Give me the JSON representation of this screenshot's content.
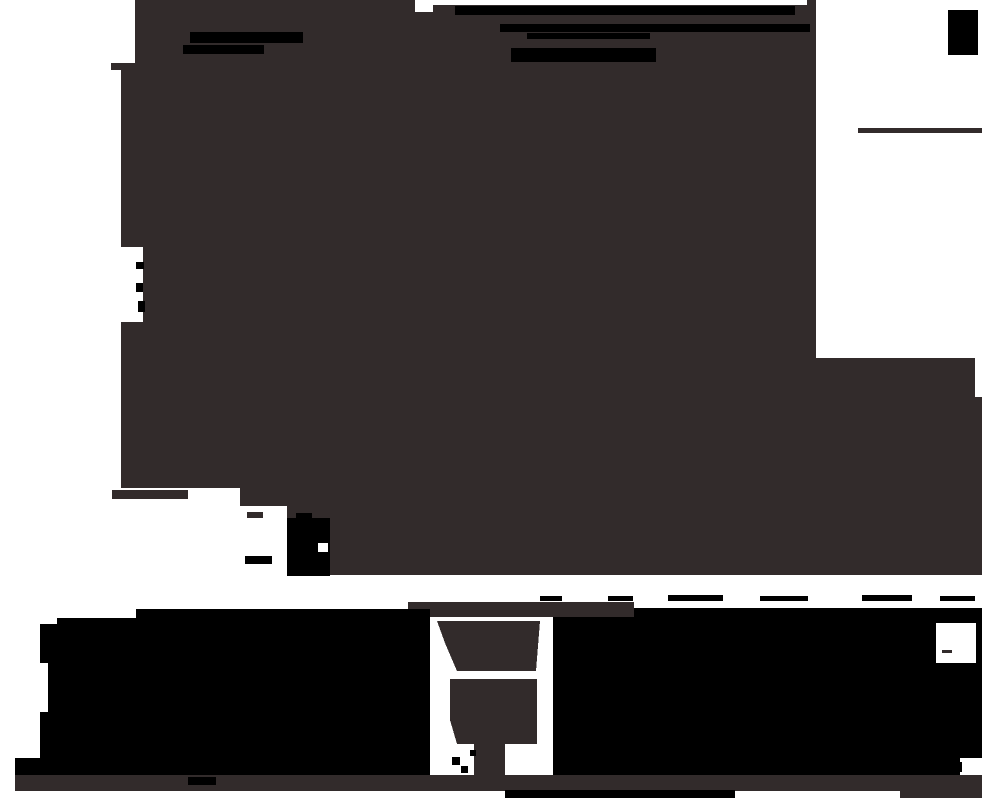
{
  "image": {
    "description": "Abstract monochrome silhouette composition: large dark-brown irregular mass over white, black stripe accents, white cutouts, black bottom blocks with funnel-shaped gap and thin base band",
    "width": 982,
    "height": 798
  },
  "palette": {
    "paper": "#ffffff",
    "mass": "#322b2b",
    "ink": "#000000"
  },
  "shapes": [
    {
      "name": "main-dark-mass",
      "type": "polygon",
      "fill": "mass",
      "points": "137,0 816,0 816,358 975,358 975,397 982,397 982,575 330,575 330,520 287,520 287,506 240,506 240,488 121,488 121,322 143,322 143,247 121,247 121,70 111,70 111,63 135,63 135,0"
    },
    {
      "name": "top-white-sliver",
      "type": "rect",
      "fill": "paper",
      "x": 430,
      "y": 0,
      "w": 377,
      "h": 5
    },
    {
      "name": "top-white-notch",
      "type": "rect",
      "fill": "paper",
      "x": 415,
      "y": 0,
      "w": 18,
      "h": 12
    },
    {
      "name": "top-stripe-left-1",
      "type": "rect",
      "fill": "ink",
      "x": 190,
      "y": 32,
      "w": 113,
      "h": 11
    },
    {
      "name": "top-stripe-left-2",
      "type": "rect",
      "fill": "ink",
      "x": 183,
      "y": 45,
      "w": 81,
      "h": 9
    },
    {
      "name": "top-stripe-right-1",
      "type": "rect",
      "fill": "ink",
      "x": 455,
      "y": 6,
      "w": 340,
      "h": 9
    },
    {
      "name": "top-stripe-right-2",
      "type": "rect",
      "fill": "ink",
      "x": 500,
      "y": 24,
      "w": 310,
      "h": 8
    },
    {
      "name": "top-stripe-right-3",
      "type": "rect",
      "fill": "ink",
      "x": 527,
      "y": 33,
      "w": 123,
      "h": 6
    },
    {
      "name": "top-stripe-right-4",
      "type": "rect",
      "fill": "ink",
      "x": 511,
      "y": 48,
      "w": 145,
      "h": 14
    },
    {
      "name": "top-right-patch",
      "type": "rect",
      "fill": "ink",
      "x": 948,
      "y": 10,
      "w": 30,
      "h": 45
    },
    {
      "name": "white-column-line",
      "type": "rect",
      "fill": "mass",
      "x": 858,
      "y": 128,
      "w": 124,
      "h": 5
    },
    {
      "name": "left-notch-dot-1",
      "type": "rect",
      "fill": "ink",
      "x": 136,
      "y": 262,
      "w": 8,
      "h": 7
    },
    {
      "name": "left-notch-dot-2",
      "type": "rect",
      "fill": "ink",
      "x": 136,
      "y": 283,
      "w": 7,
      "h": 9
    },
    {
      "name": "left-notch-dot-3",
      "type": "rect",
      "fill": "ink",
      "x": 138,
      "y": 301,
      "w": 7,
      "h": 11
    },
    {
      "name": "edge-foot",
      "type": "rect",
      "fill": "mass",
      "x": 112,
      "y": 490,
      "w": 76,
      "h": 9
    },
    {
      "name": "edge-step-dash",
      "type": "rect",
      "fill": "mass",
      "x": 247,
      "y": 512,
      "w": 16,
      "h": 6
    },
    {
      "name": "mid-blob-body",
      "type": "rect",
      "fill": "ink",
      "x": 287,
      "y": 518,
      "w": 43,
      "h": 58
    },
    {
      "name": "mid-blob-spur",
      "type": "rect",
      "fill": "ink",
      "x": 296,
      "y": 513,
      "w": 16,
      "h": 9
    },
    {
      "name": "mid-blob-white-notch",
      "type": "rect",
      "fill": "paper",
      "x": 318,
      "y": 543,
      "w": 10,
      "h": 9
    },
    {
      "name": "mid-blob-dash",
      "type": "rect",
      "fill": "ink",
      "x": 245,
      "y": 556,
      "w": 27,
      "h": 8
    },
    {
      "name": "band-dash-1",
      "type": "rect",
      "fill": "ink",
      "x": 540,
      "y": 596,
      "w": 22,
      "h": 5
    },
    {
      "name": "band-dash-2",
      "type": "rect",
      "fill": "ink",
      "x": 608,
      "y": 596,
      "w": 25,
      "h": 5
    },
    {
      "name": "band-dash-3",
      "type": "rect",
      "fill": "ink",
      "x": 668,
      "y": 595,
      "w": 55,
      "h": 6
    },
    {
      "name": "band-dash-4",
      "type": "rect",
      "fill": "ink",
      "x": 760,
      "y": 596,
      "w": 48,
      "h": 5
    },
    {
      "name": "band-dash-5",
      "type": "rect",
      "fill": "ink",
      "x": 862,
      "y": 595,
      "w": 50,
      "h": 6
    },
    {
      "name": "band-dash-6",
      "type": "rect",
      "fill": "ink",
      "x": 940,
      "y": 596,
      "w": 35,
      "h": 5
    },
    {
      "name": "bottom-brown-top-band",
      "type": "rect",
      "fill": "mass",
      "x": 408,
      "y": 602,
      "w": 226,
      "h": 15
    },
    {
      "name": "bottom-left-block",
      "type": "polygon",
      "fill": "ink",
      "points": "40,624 57,624 57,618 136,618 136,609 430,609 430,775 15,775 15,758 40,758"
    },
    {
      "name": "bottom-left-step-notch",
      "type": "rect",
      "fill": "paper",
      "x": 40,
      "y": 663,
      "w": 8,
      "h": 49
    },
    {
      "name": "bottom-right-block",
      "type": "polygon",
      "fill": "ink",
      "points": "553,617 634,617 634,608 982,608 982,758 960,758 960,775 553,775"
    },
    {
      "name": "bottom-right-top-notch",
      "type": "rect",
      "fill": "paper",
      "x": 936,
      "y": 623,
      "w": 40,
      "h": 40
    },
    {
      "name": "bottom-right-notch-dash",
      "type": "rect",
      "fill": "mass",
      "x": 942,
      "y": 650,
      "w": 10,
      "h": 3
    },
    {
      "name": "bottom-right-corner-notch",
      "type": "rect",
      "fill": "paper",
      "x": 960,
      "y": 758,
      "w": 22,
      "h": 17
    },
    {
      "name": "bottom-right-corner-mark",
      "type": "rect",
      "fill": "ink",
      "x": 952,
      "y": 762,
      "w": 10,
      "h": 10
    },
    {
      "name": "funnel-trapezoid",
      "type": "polygon",
      "fill": "mass",
      "points": "437,621 540,621 536,671 457,671 445,643"
    },
    {
      "name": "funnel-body",
      "type": "polygon",
      "fill": "mass",
      "points": "450,679 537,679 537,744 505,744 505,775 474,775 474,744 457,744 450,720"
    },
    {
      "name": "funnel-zig-1",
      "type": "rect",
      "fill": "ink",
      "x": 452,
      "y": 757,
      "w": 8,
      "h": 8
    },
    {
      "name": "funnel-zig-2",
      "type": "rect",
      "fill": "ink",
      "x": 461,
      "y": 766,
      "w": 7,
      "h": 7
    },
    {
      "name": "funnel-zig-3",
      "type": "rect",
      "fill": "ink",
      "x": 470,
      "y": 750,
      "w": 6,
      "h": 6
    },
    {
      "name": "base-band",
      "type": "polygon",
      "fill": "mass",
      "points": "15,775 982,775 982,798 900,798 900,791 15,791"
    },
    {
      "name": "base-band-black-bar",
      "type": "rect",
      "fill": "ink",
      "x": 188,
      "y": 777,
      "w": 28,
      "h": 8
    },
    {
      "name": "bottom-edge-black-bar",
      "type": "rect",
      "fill": "ink",
      "x": 505,
      "y": 790,
      "w": 230,
      "h": 8
    }
  ]
}
